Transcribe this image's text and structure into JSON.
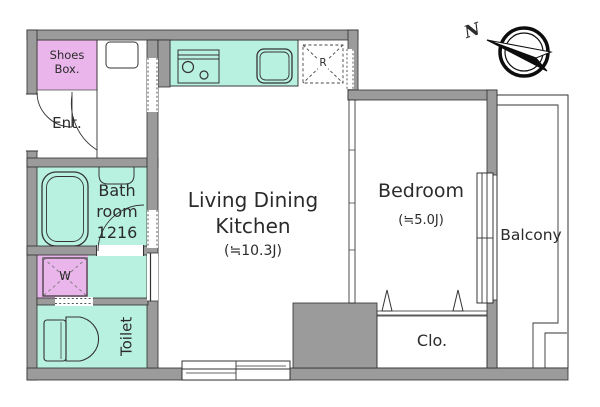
{
  "colors": {
    "wall": "#9b9b9b",
    "mint": "#b9f1e1",
    "pink": "#eab5ea",
    "pink_light": "#f2c6f2",
    "outline": "#333333"
  },
  "compass": {
    "north_label": "N"
  },
  "rooms": {
    "shoes_box": {
      "label": "Shoes Box."
    },
    "entrance": {
      "label": "Ent."
    },
    "bathroom": {
      "label": "Bath room 1216"
    },
    "washroom": {
      "washing_machine_label": "W"
    },
    "toilet": {
      "label": "Toilet"
    },
    "living_dining_kitchen": {
      "label": "Living Dining Kitchen",
      "area": "(≒10.3J)"
    },
    "bedroom": {
      "label": "Bedroom",
      "area": "(≒5.0J)"
    },
    "balcony": {
      "label": "Balcony"
    },
    "closet": {
      "label": "Clo."
    },
    "kitchen": {
      "refrigerator_label": "R"
    }
  }
}
